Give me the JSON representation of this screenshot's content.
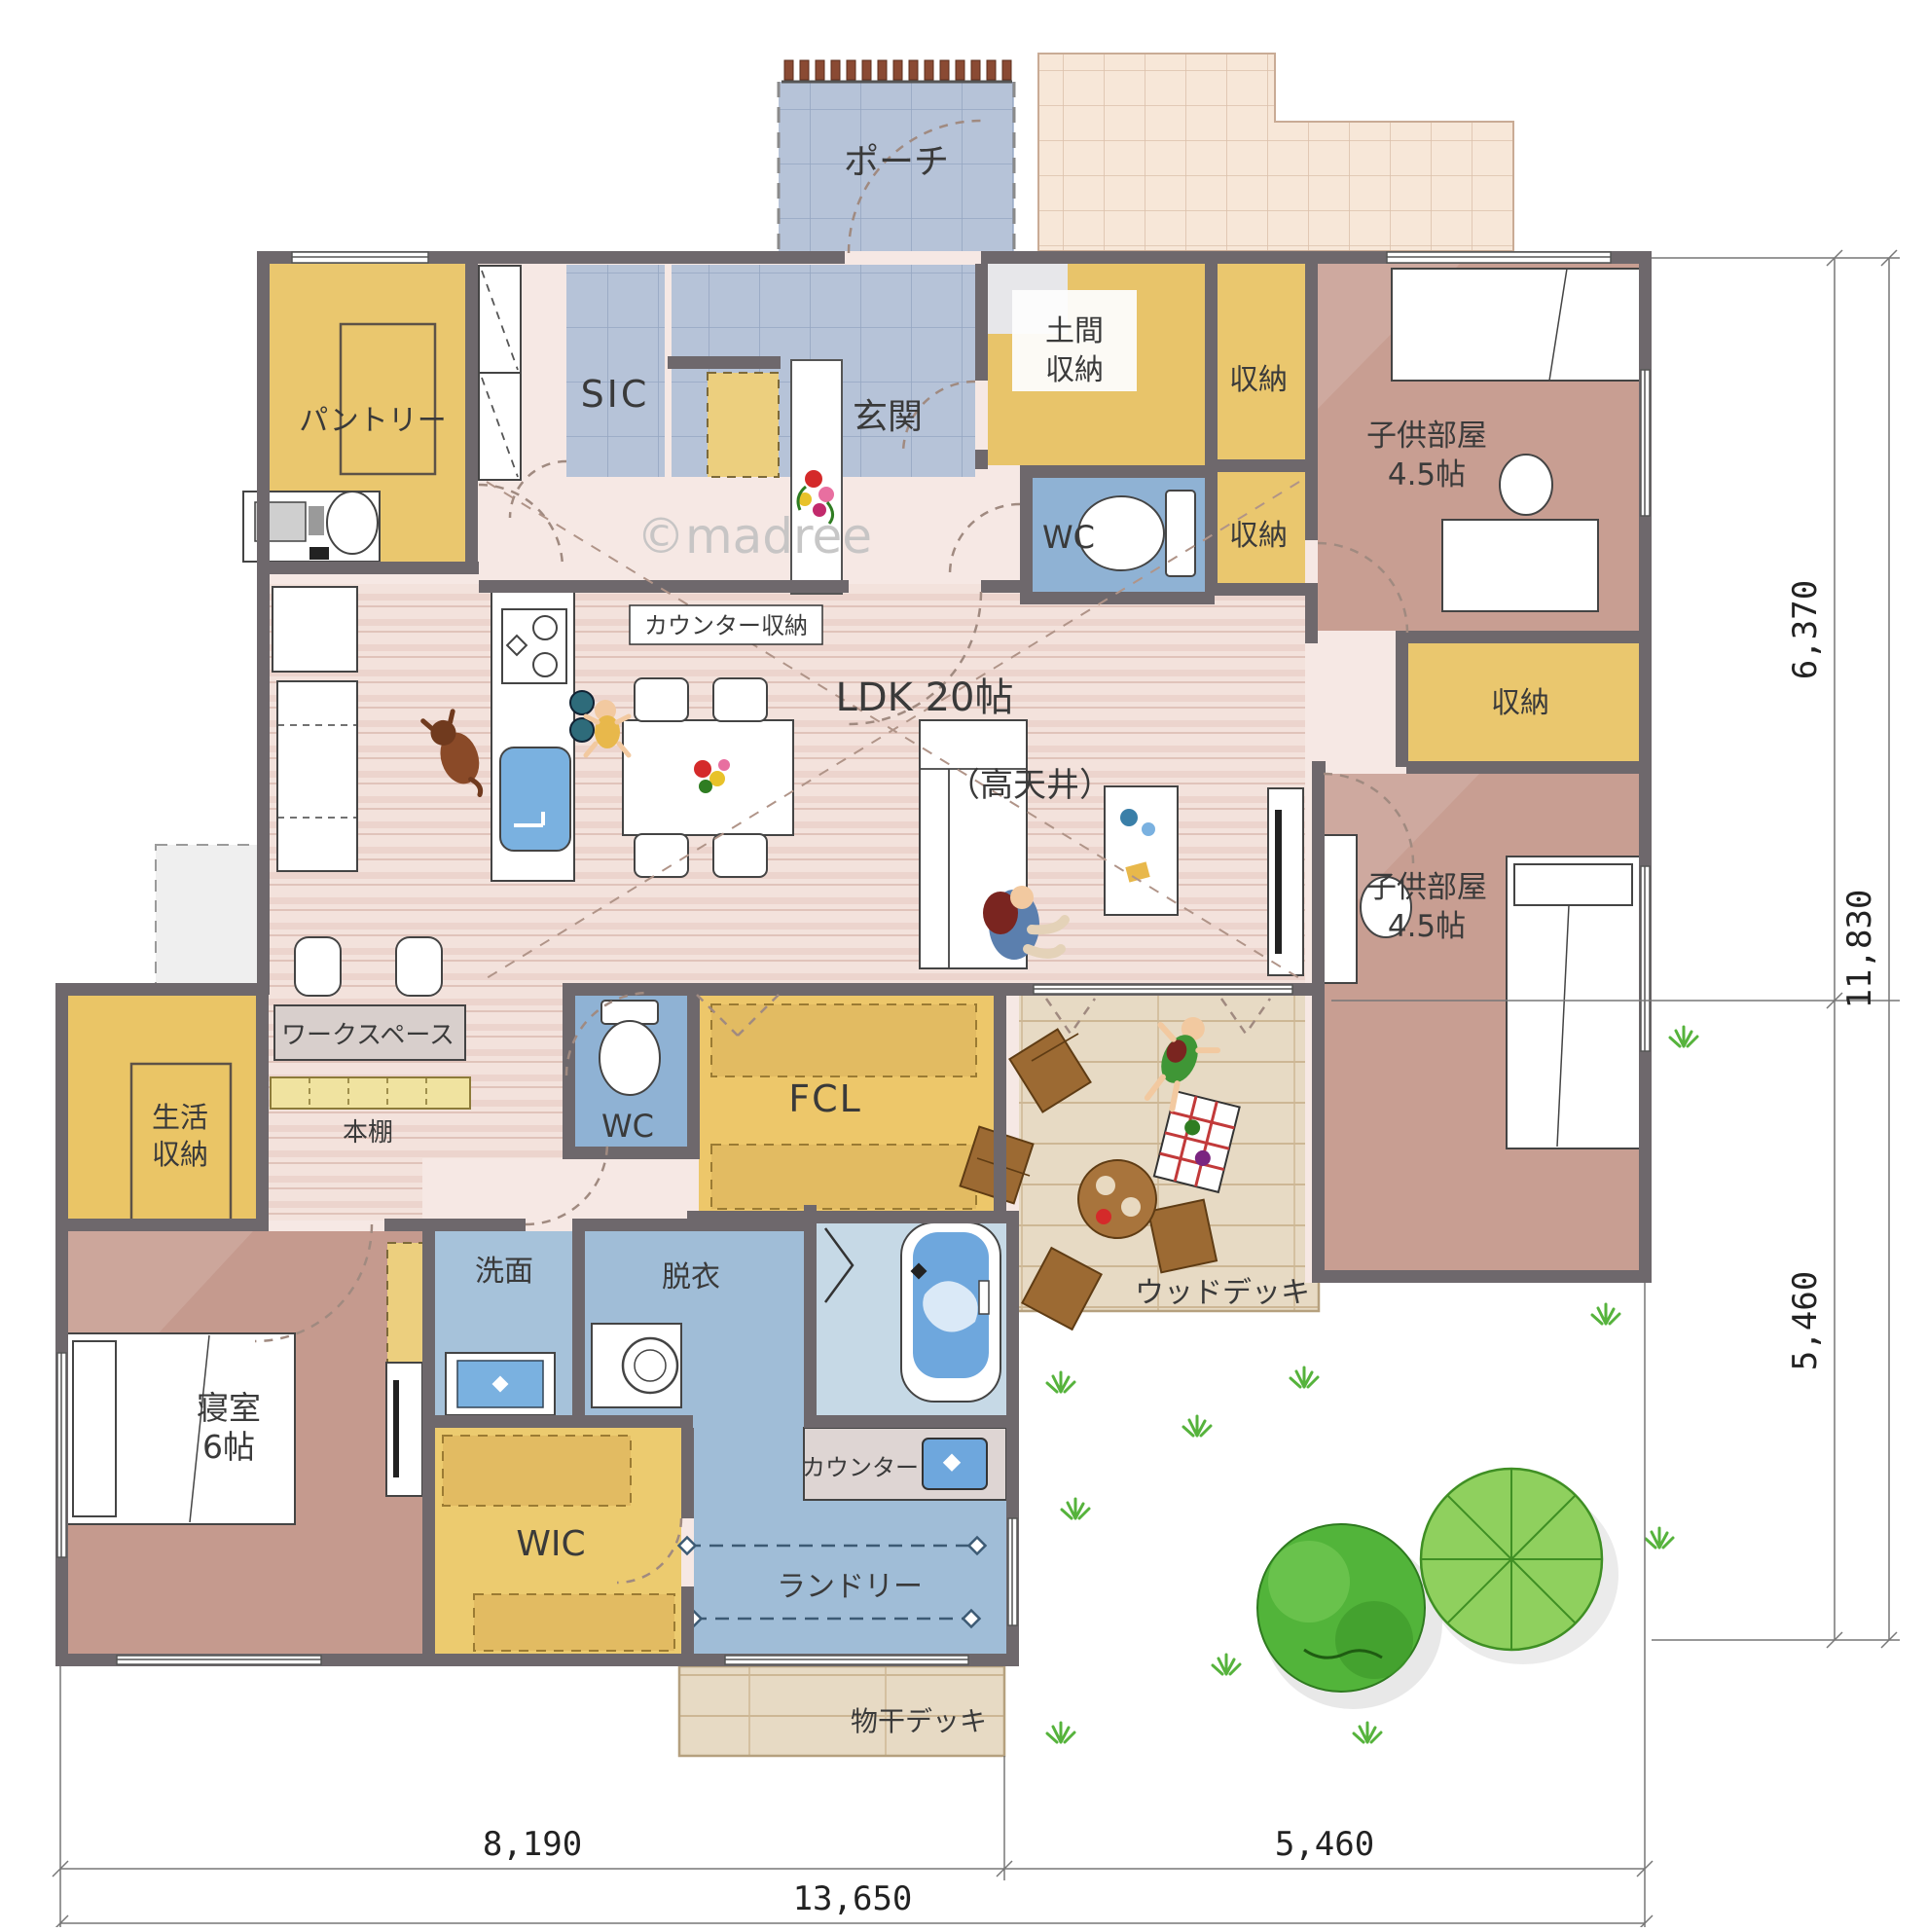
{
  "watermark": "©madree",
  "rooms": {
    "porch": {
      "label": "ポーチ"
    },
    "entrance": {
      "label": "玄関"
    },
    "sic": {
      "label": "SIC"
    },
    "pantry": {
      "label": "パントリー"
    },
    "doma_storage": {
      "line1": "土間",
      "line2": "収納"
    },
    "storage_top": {
      "label": "収納"
    },
    "storage_mid": {
      "label": "収納"
    },
    "wc_1": {
      "label": "WC"
    },
    "kids_room_1": {
      "label": "子供部屋",
      "size": "4.5帖"
    },
    "counter_storage": {
      "label": "カウンター収納"
    },
    "ldk": {
      "label": "LDK 20帖",
      "note": "（高天井）"
    },
    "storage_kids": {
      "label": "収納"
    },
    "kids_room_2": {
      "label": "子供部屋",
      "size": "4.5帖"
    },
    "workspace": {
      "label": "ワークスペース"
    },
    "bookshelf": {
      "label": "本棚"
    },
    "life_storage": {
      "line1": "生活",
      "line2": "収納"
    },
    "wc_2": {
      "label": "WC"
    },
    "fcl": {
      "label": "FCL"
    },
    "washroom": {
      "label": "洗面"
    },
    "dressing": {
      "label": "脱衣"
    },
    "bedroom": {
      "label": "寝室",
      "size": "6帖"
    },
    "wic": {
      "label": "WIC"
    },
    "counter": {
      "label": "カウンター"
    },
    "laundry": {
      "label": "ランドリー"
    },
    "wood_deck": {
      "label": "ウッドデッキ"
    },
    "drying_deck": {
      "label": "物干デッキ"
    }
  },
  "dimensions": {
    "right_top": "6,370",
    "right_bottom": "5,460",
    "right_total": "11,830",
    "bottom_left": "8,190",
    "bottom_right": "5,460",
    "bottom_total": "13,650"
  },
  "colors": {
    "wall": "#6e686c",
    "tile_floor": "#b6c3d8",
    "wood_floor": "#f3e2dc",
    "storage_yellow": "#eac76e",
    "room_brown": "#c89e92",
    "wet_blue": "#a6c2da",
    "bath_blue": "#c6d9e6",
    "deck_wood": "#e7dac4",
    "approach_tile": "#f7e7d8",
    "lawn_green": "#56b33c"
  }
}
